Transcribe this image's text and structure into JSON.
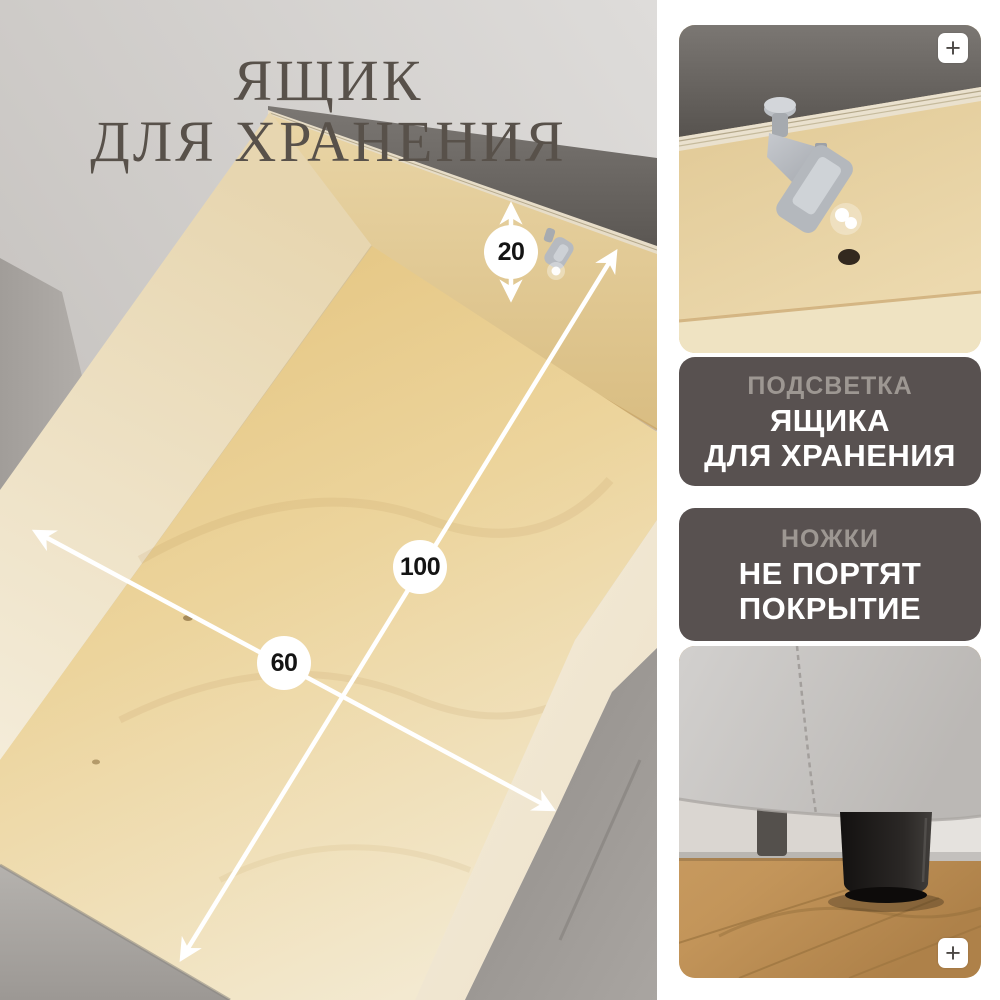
{
  "title": {
    "line1": "ЯЩИК",
    "line2": "ДЛЯ ХРАНЕНИЯ"
  },
  "dimensions": {
    "depth_cm": "20",
    "length_cm": "100",
    "width_cm": "60"
  },
  "features": [
    {
      "muted": "ПОДСВЕТКА",
      "strong1": "ЯЩИКА",
      "strong2": "ДЛЯ ХРАНЕНИЯ"
    },
    {
      "muted": "НОЖКИ",
      "strong1": "НЕ ПОРТЯТ",
      "strong2": "ПОКРЫТИЕ"
    }
  ],
  "icons": {
    "zoom_plus": "+"
  },
  "colors": {
    "caption_background": "#585150",
    "caption_muted_text": "#9d9792",
    "caption_strong_text": "#ffffff",
    "title_text": "#58514a",
    "arrow": "#ffffff",
    "badge_background": "#ffffff"
  }
}
